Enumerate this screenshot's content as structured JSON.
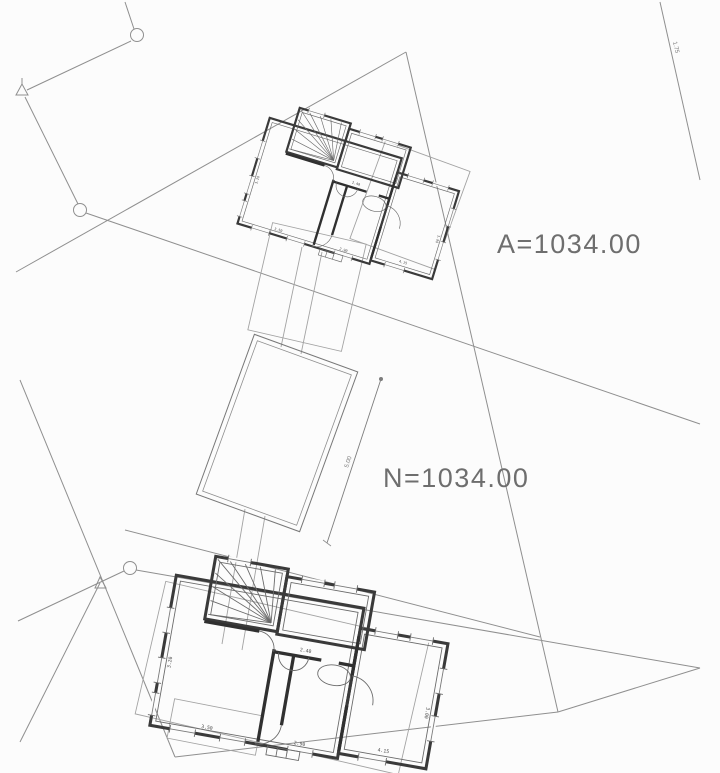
{
  "labels": {
    "area": "A=1034.00",
    "level": "N=1034.00",
    "boundary_segment": "1.75",
    "pool_dimension": "5.00"
  },
  "plan": {
    "dims": [
      "3.50",
      "2.90",
      "3.20",
      "4.15",
      "2.40",
      "3.00"
    ]
  },
  "colors": {
    "background": "#fcfcfc",
    "boundary_line": "#8f8f8f",
    "wall": "#3a3a3a",
    "light_line": "#a3a3a3",
    "text": "#6e6e6e"
  }
}
